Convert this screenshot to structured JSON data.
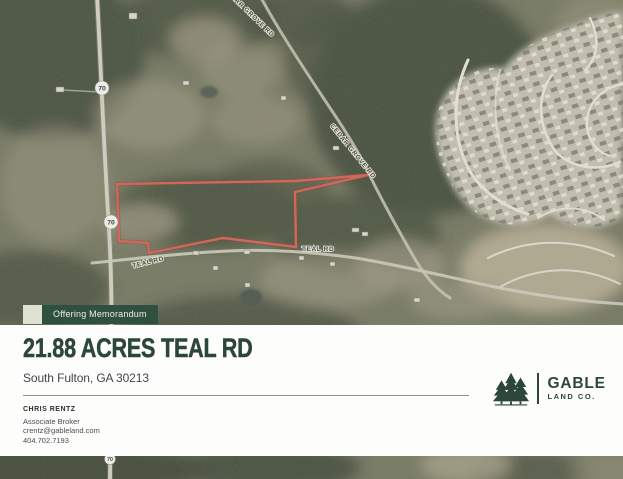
{
  "map": {
    "labels": {
      "cedar_grove": "CEDAR GROVE RD",
      "teal": "TEAL RD"
    },
    "shield": "70",
    "boundary_color": "#dd5645"
  },
  "panel": {
    "badge": "Offering Memorandum",
    "title": "21.88 ACRES TEAL RD",
    "subtitle": "South Fulton, GA 30213",
    "contact": {
      "name": "CHRIS RENTZ",
      "role": "Associate Broker",
      "email": "crentz@gableland.com",
      "phone": "404.702.7193"
    },
    "logo": {
      "primary": "GABLE",
      "secondary": "LAND CO."
    }
  },
  "colors": {
    "brand_green": "#2c473a",
    "badge_green": "#30503f",
    "badge_beige": "#e0e2d1",
    "boundary_red": "#dd5645"
  }
}
